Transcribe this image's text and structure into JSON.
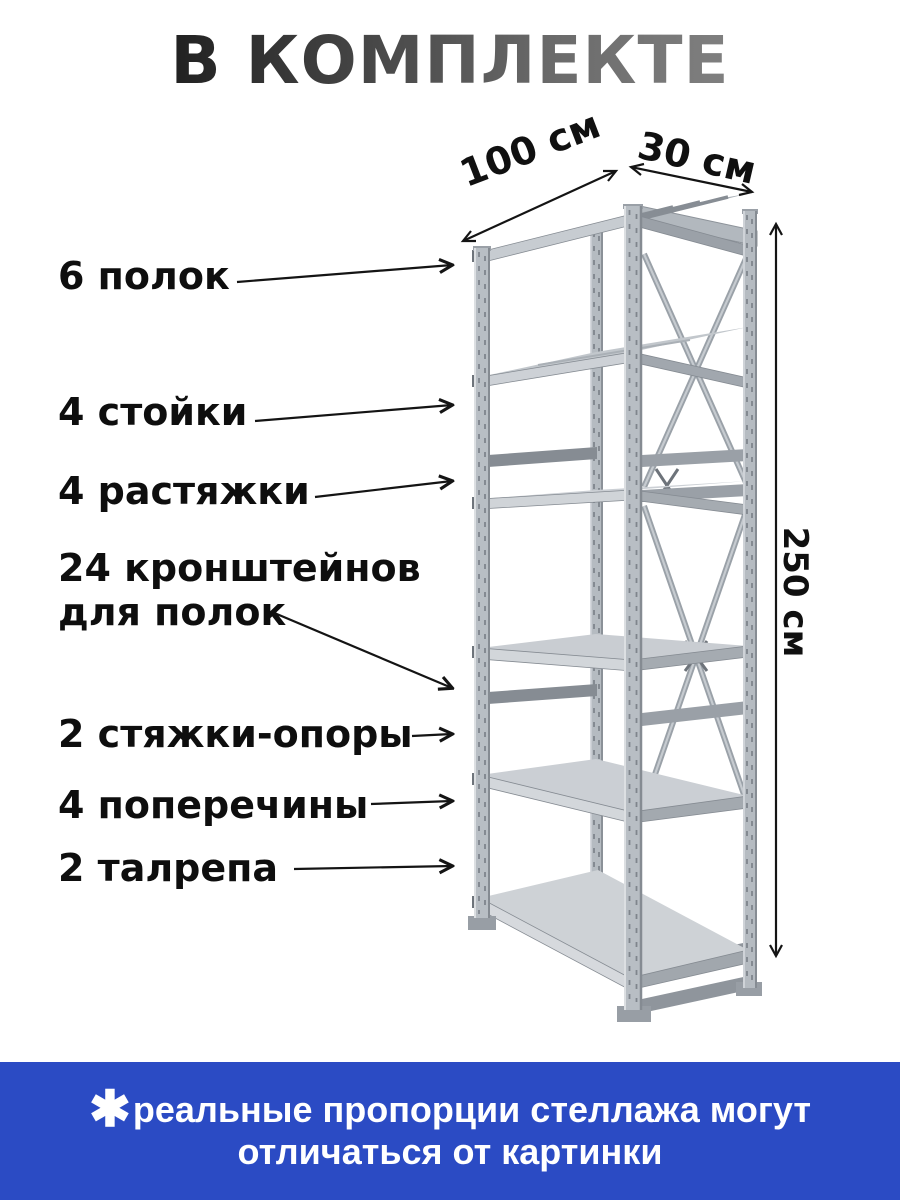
{
  "header": {
    "title": "В КОМПЛЕКТЕ"
  },
  "labels": [
    {
      "text": "6 полок"
    },
    {
      "text": "4 стойки"
    },
    {
      "text": "4 растяжки"
    },
    {
      "text": "24 кронштейнов для полок"
    },
    {
      "text": "2 стяжки-опоры"
    },
    {
      "text": "4 поперечины"
    },
    {
      "text": "2 талрепа"
    }
  ],
  "dimensions": {
    "width": "100 см",
    "depth": "30 см",
    "height": "250 см"
  },
  "rack": {
    "shelf_count": 6,
    "post_count": 4,
    "illustration": "metal-shelving-rack"
  },
  "footnote": {
    "mark": "✱",
    "line1": "реальные пропорции стеллажа могут",
    "line2": "отличаться от картинки"
  },
  "colors": {
    "banner_blue": "#2b4bc4",
    "metal_light": "#c9cdd2",
    "metal_mid": "#a5abb1",
    "metal_dark": "#8f959c",
    "ink": "#141414"
  }
}
